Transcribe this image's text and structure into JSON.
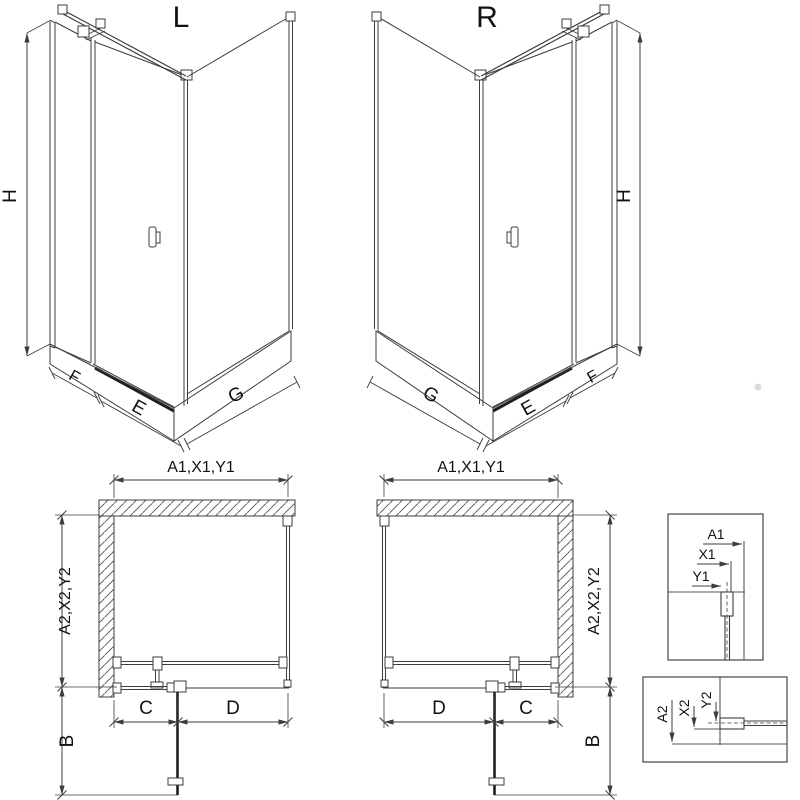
{
  "colors": {
    "line": "#3d3d3d",
    "dark_line": "#1f1f1f",
    "hatch": "#4a4a4a",
    "detail_box_border": "#555555",
    "text": "#111111",
    "background": "#ffffff"
  },
  "iso_views": {
    "left": {
      "label": "L",
      "height_dim": "H",
      "fixed_panel_dim": "F",
      "door_dim": "E",
      "side_panel_dim": "G"
    },
    "right": {
      "label": "R",
      "height_dim": "H",
      "fixed_panel_dim": "F",
      "door_dim": "E",
      "side_panel_dim": "G"
    }
  },
  "plan_views": {
    "left": {
      "width_dim": "A1,X1,Y1",
      "depth_dim": "A2,X2,Y2",
      "fixed_segment_dim": "C",
      "door_segment_dim": "D",
      "door_swing_dim": "B"
    },
    "right": {
      "width_dim": "A1,X1,Y1",
      "depth_dim": "A2,X2,Y2",
      "fixed_segment_dim": "C",
      "door_segment_dim": "D",
      "door_swing_dim": "B"
    }
  },
  "detail_views": {
    "top_profile": {
      "dim1": "A1",
      "dim2": "X1",
      "dim3": "Y1"
    },
    "bottom_profile": {
      "dim1": "A2",
      "dim2": "X2",
      "dim3": "Y2"
    }
  }
}
